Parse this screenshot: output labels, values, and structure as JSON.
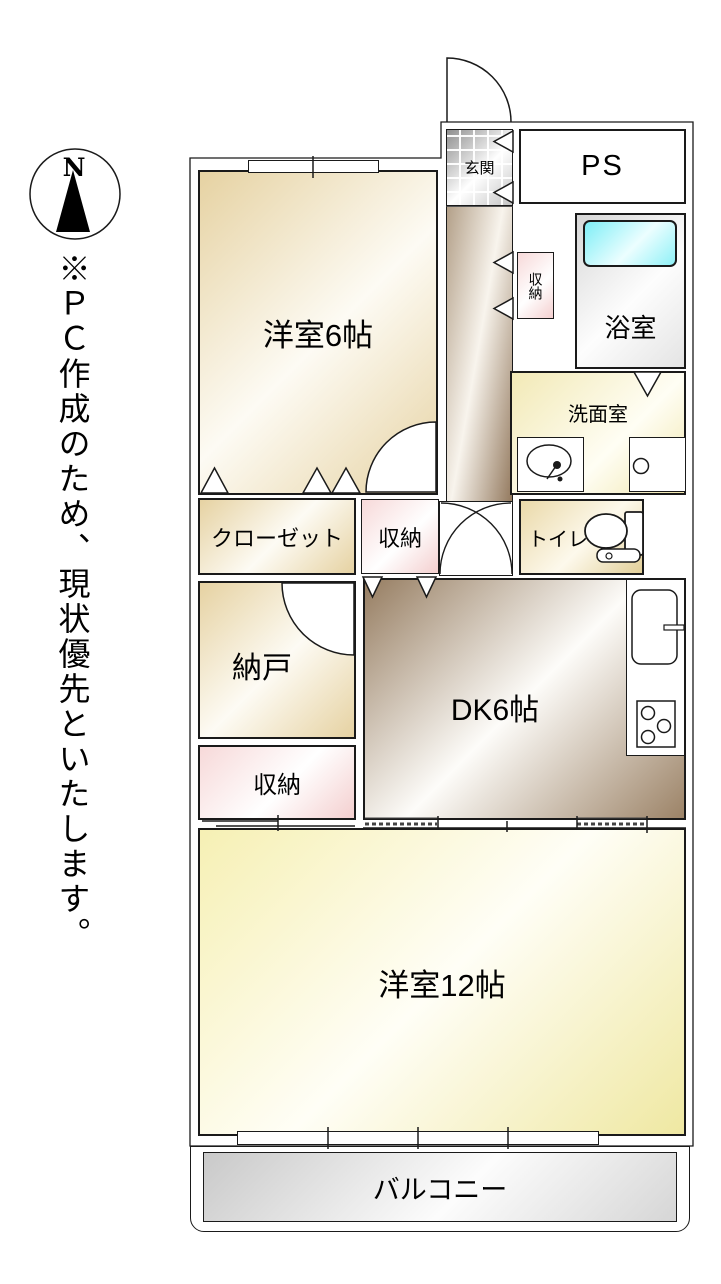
{
  "note": {
    "text": "※ＰＣ作成のため、現状優先といたします。"
  },
  "compass": {
    "label": "N"
  },
  "rooms": {
    "genkan": {
      "label": "玄関"
    },
    "ps": {
      "label": "PS"
    },
    "bath": {
      "label": "浴室"
    },
    "hall_storage": {
      "label": "収納"
    },
    "senmen": {
      "label": "洗面室"
    },
    "toilet": {
      "label": "トイレ"
    },
    "yoshitsu6": {
      "label": "洋室6帖"
    },
    "closet": {
      "label": "クローゼット"
    },
    "storage2": {
      "label": "収納"
    },
    "nando": {
      "label": "納戸"
    },
    "dk": {
      "label": "DK6帖"
    },
    "storage3": {
      "label": "収納"
    },
    "yoshitsu12": {
      "label": "洋室12帖"
    },
    "balcony": {
      "label": "バルコニー"
    }
  },
  "colors": {
    "wall_line": "#1a1a1a",
    "room_beige": "#e6d2a2",
    "room_yellow": "#f6f0b4",
    "storage_pink": "#f7d9d9",
    "floor_brown": "#967d61",
    "washroom_yellow": "#f2e9b6",
    "bathtub_cyan": "#7eeef6",
    "bath_gray": "#d7d7d7",
    "balcony_gray": "#c9c9c9",
    "entrance_tile_gray": "#8f8f8f"
  }
}
